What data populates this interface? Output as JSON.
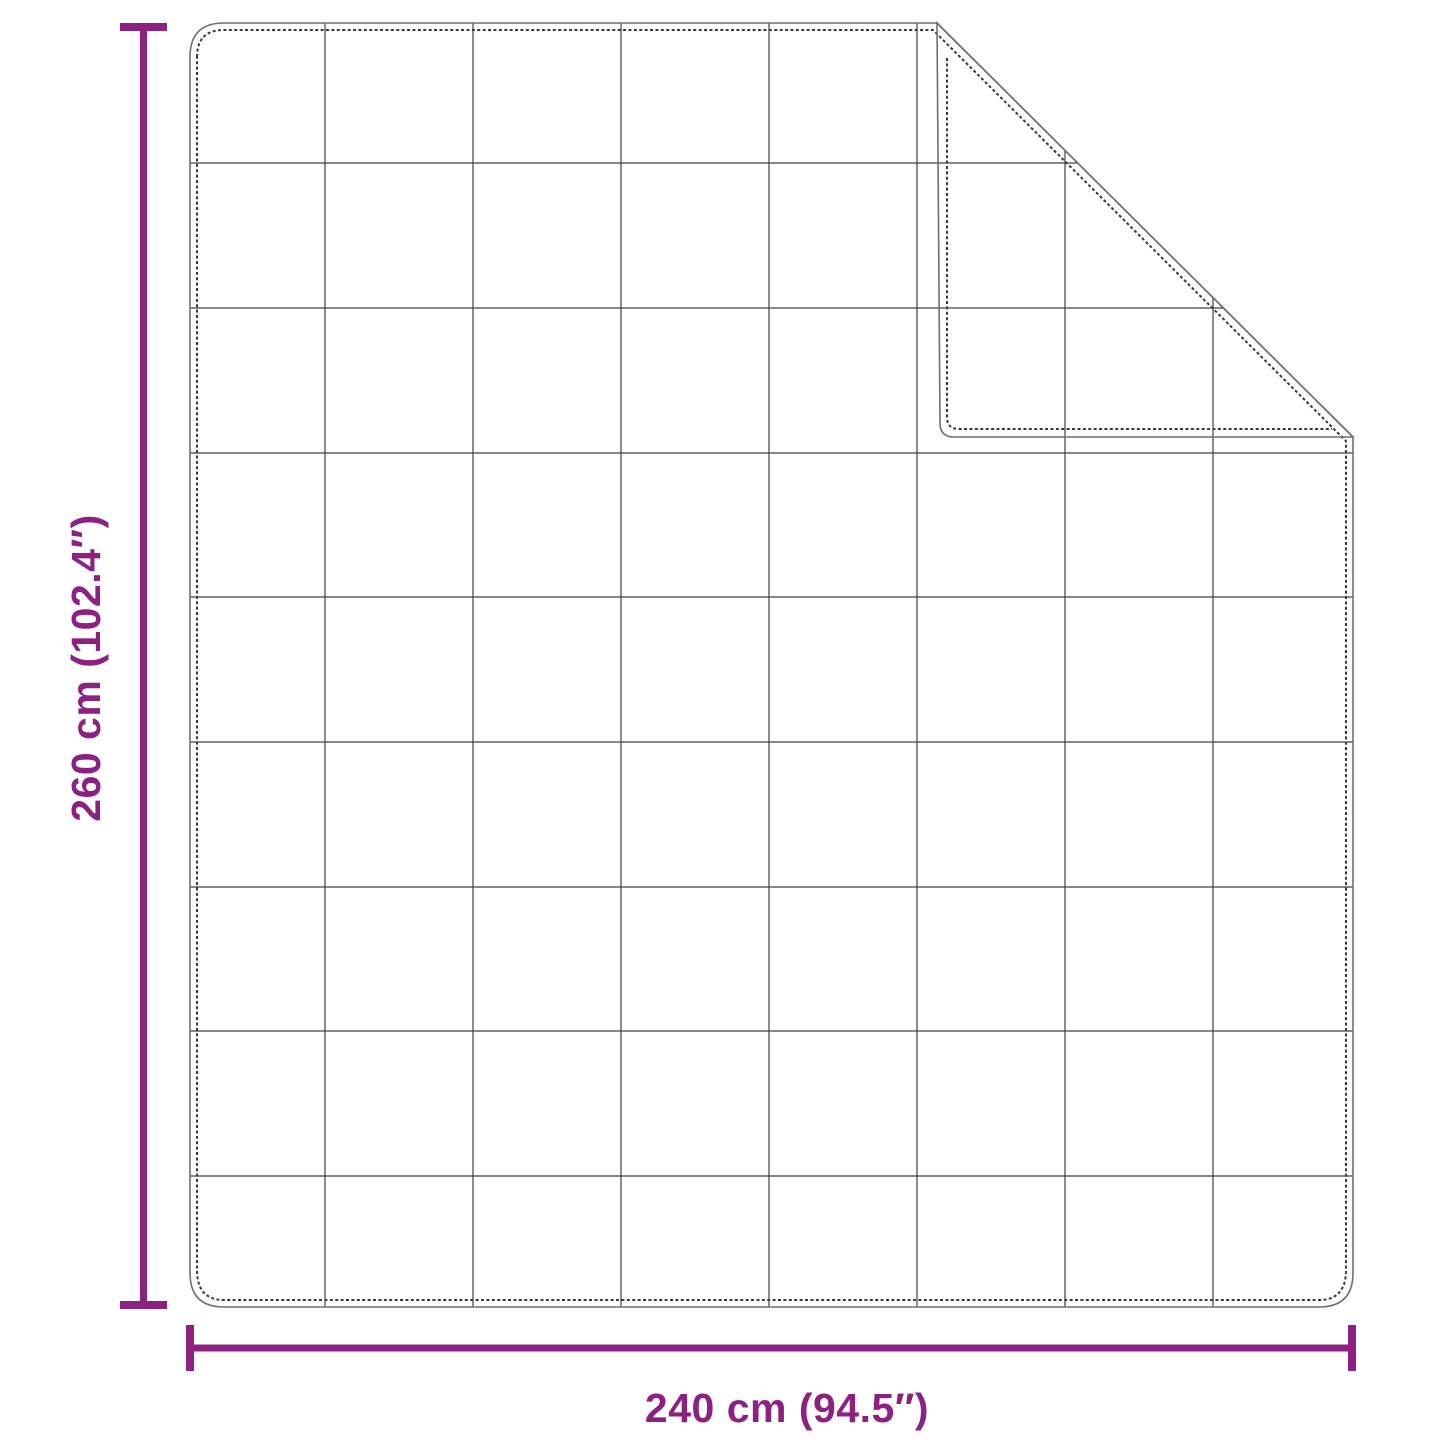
{
  "diagram": {
    "title": "blanket-dimension-diagram",
    "height_label": "260 cm (102.4″)",
    "width_label": "240 cm (94.5″)",
    "grid": {
      "columns": 8,
      "rows": 9,
      "flap_visible_columns": 3,
      "flap_visible_rows": 3
    }
  },
  "colors": {
    "dimension_accent": "#8c2182",
    "outline": "#6f6f6f",
    "stitch_line": "#3a3a3a",
    "grid_line": "#404040",
    "background": "#ffffff",
    "fabric_fill": "#ffffff"
  }
}
